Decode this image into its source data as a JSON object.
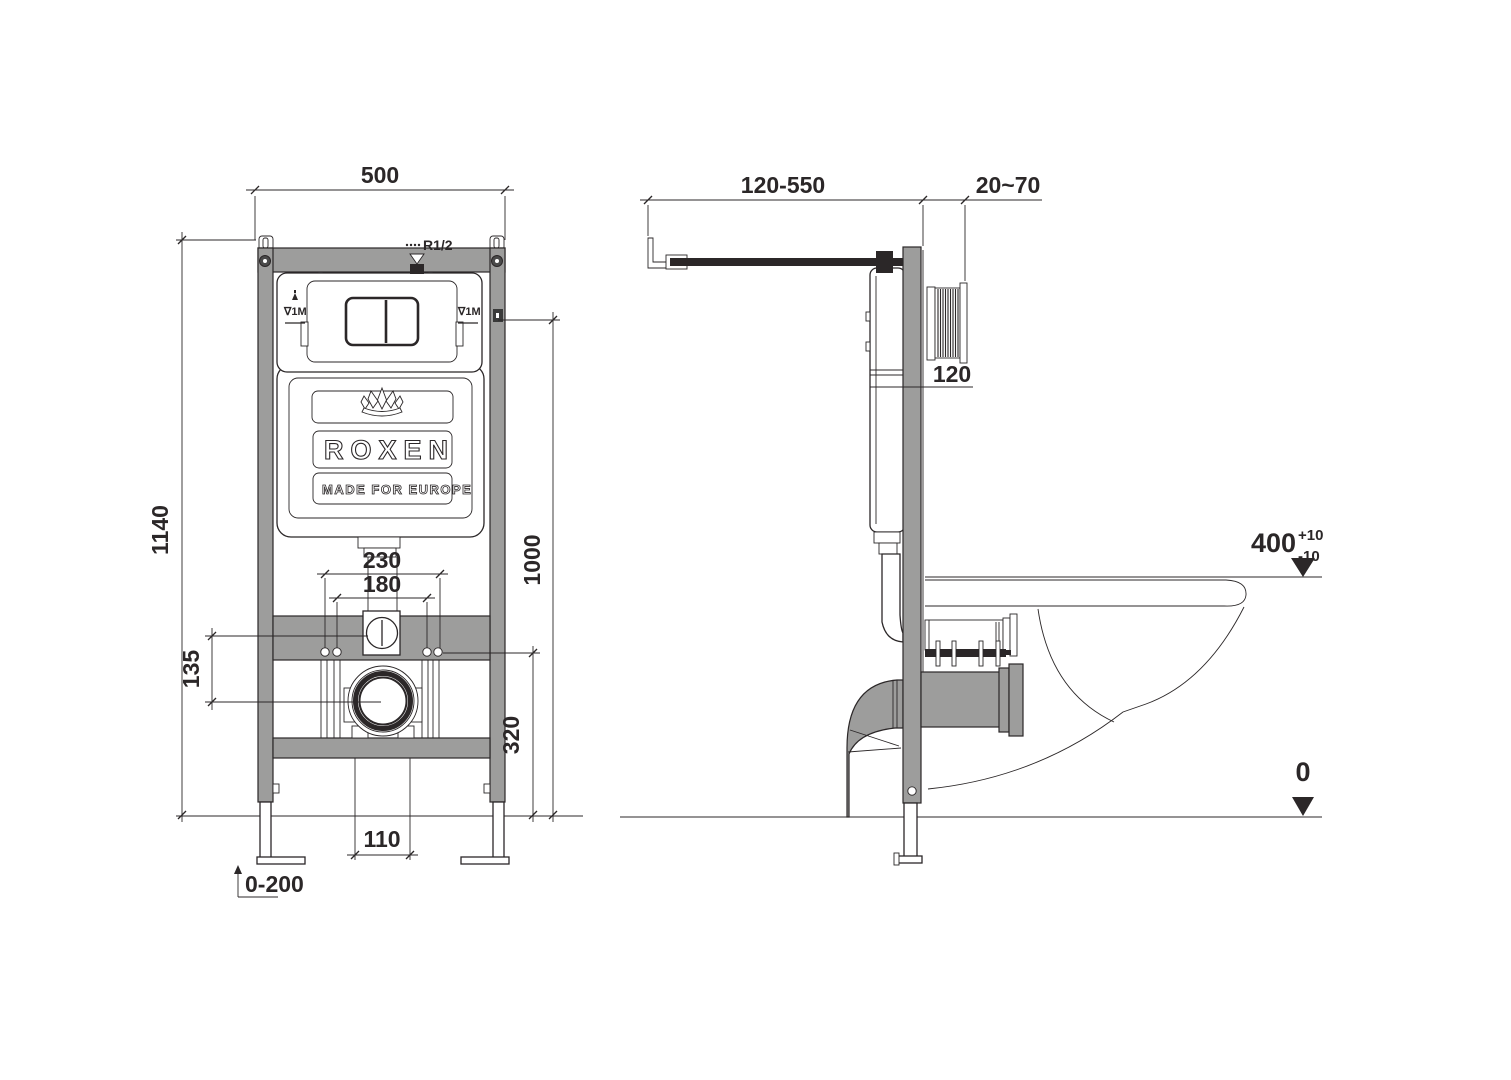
{
  "colors": {
    "line": "#2b2728",
    "gray": "#9d9d9c",
    "background": "#ffffff",
    "text": "#2b2728"
  },
  "brand": {
    "name": "ROXEN",
    "tagline": "MADE FOR EUROPE",
    "logo": "lotus-crown-icon"
  },
  "front_view": {
    "dim_width": "500",
    "dim_height": "1140",
    "dim_inlet_height": "1000",
    "dim_bolt_outer": "230",
    "dim_bolt_inner": "180",
    "dim_inlet_drop": "135",
    "dim_drain_height": "320",
    "dim_outlet_width": "110",
    "dim_leg_range": "0-200",
    "label_supply": "R1/2",
    "label_level": "∇1M"
  },
  "side_view": {
    "dim_bracket": "120-550",
    "dim_wall": "20~70",
    "dim_depth": "120",
    "dim_rim": "400",
    "dim_rim_plus": "+10",
    "dim_rim_minus": "-10",
    "dim_floor": "0"
  }
}
